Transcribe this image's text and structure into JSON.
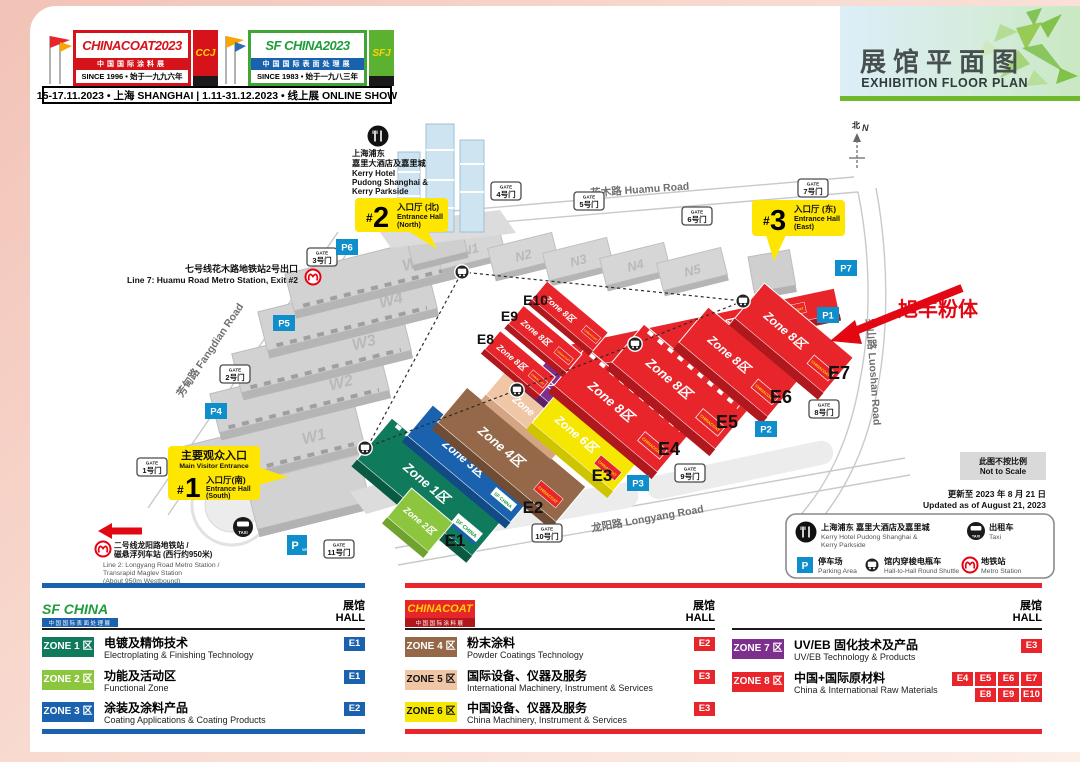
{
  "header": {
    "chinacoat": {
      "name": "CHINACOAT",
      "year": "2023",
      "tagline": "中国国际涂料展",
      "since": "SINCE 1996 • 始于一九九六年",
      "badge": "CCJ"
    },
    "sfchina": {
      "name": "SF CHINA",
      "year": "2023",
      "tagline": "中国国际表面处理展",
      "since": "SINCE 1983 • 始于一九八三年",
      "badge": "SFJ"
    },
    "dates": "15-17.11.2023 • 上海 SHANGHAI | 1.11-31.12.2023 • 线上展 ONLINE SHOW",
    "title_cn": "展馆平面图",
    "title_en": "EXHIBITION FLOOR PLAN"
  },
  "map": {
    "compass": {
      "cn": "北",
      "en": "N"
    },
    "roads": {
      "huamu": "花木路  Huamu Road",
      "fangdian": "芳甸路  Fangdian Road",
      "longyang": "龙阳路  Longyang Road",
      "luoshan": "罗山路  Luoshan Road"
    },
    "kerry": {
      "cn1": "上海浦东",
      "cn2": "嘉里大酒店及嘉里城",
      "en1": "Kerry Hotel",
      "en2": "Pudong Shanghai &",
      "en3": "Kerry Parkside"
    },
    "metro_line7": {
      "cn": "七号线花木路地铁站2号出口",
      "en": "Line 7: Huamu Road Metro Station, Exit #2"
    },
    "metro_line2": {
      "cn1": "二号线龙阳路地铁站 /",
      "cn2": "磁悬浮列车站 (西行约950米)",
      "en1": "Line 2: Longyang Road Metro Station /",
      "en2": "Transrapid Maglev Station",
      "en3": "(About 950m Westbound)"
    },
    "entrance1": {
      "main_cn": "主要观众入口",
      "main_en": "Main Visitor Entrance",
      "hash": "#",
      "num": "1",
      "cn": "入口厅(南)",
      "en1": "Entrance Hall",
      "en2": "(South)"
    },
    "entrance2": {
      "hash": "#",
      "num": "2",
      "cn": "入口厅 (北)",
      "en1": "Entrance Hall",
      "en2": "(North)"
    },
    "entrance3": {
      "hash": "#",
      "num": "3",
      "cn": "入口厅 (东)",
      "en1": "Entrance Hall",
      "en2": "(East)"
    },
    "gate_word": "GATE",
    "gates": [
      "1号门",
      "2号门",
      "3号门",
      "4号门",
      "5号门",
      "6号门",
      "7号门",
      "8号门",
      "9号门",
      "10号门",
      "11号门"
    ],
    "parkings": [
      "P1",
      "P2",
      "P3",
      "P4",
      "P5",
      "P6",
      "P7"
    ],
    "parking_vip": {
      "p": "P",
      "sub": "VIP"
    },
    "west_halls": [
      "W1",
      "W2",
      "W3",
      "W4",
      "W5"
    ],
    "north_halls": [
      "N1",
      "N2",
      "N3",
      "N4",
      "N5"
    ],
    "hall_labels": [
      "E1",
      "E2",
      "E3",
      "E4",
      "E5",
      "E6",
      "E7",
      "E8",
      "E9",
      "E10"
    ],
    "zones": {
      "z1": "Zone 1区",
      "z2": "Zone 2区",
      "z3": "Zone 3区",
      "z4": "Zone 4区",
      "z5": "Zone 5区",
      "z6": "Zone 6区",
      "z7": "Zone 7区",
      "z8": "Zone 8区"
    },
    "badge_sfchina": "SF CHINA",
    "badge_chinacoat": "CHINACOAT",
    "taxi_label": "TAXI",
    "annotation": "旭丰粉体",
    "not_to_scale_cn": "此图不按比例",
    "not_to_scale_en": "Not to Scale",
    "updated_cn": "更新至 2023 年 8 月 21 日",
    "updated_en": "Updated as of August 21, 2023",
    "legend": {
      "kerry_cn": "上海浦东 嘉里大酒店及嘉里城",
      "kerry_en1": "Kerry Hotel Pudong Shanghai &",
      "kerry_en2": "Kerry Parkside",
      "taxi_cn": "出租车",
      "taxi_en": "Taxi",
      "parking_cn": "停车场",
      "parking_en": "Parking Area",
      "shuttle_cn": "馆内穿梭电瓶车",
      "shuttle_en": "Hall-to-Hall Round Shuttle",
      "metro_cn": "地铁站",
      "metro_en": "Metro Station"
    }
  },
  "tables": {
    "hall_cn": "展馆",
    "hall_en": "HALL",
    "sf": [
      {
        "zone": "ZONE 1 区",
        "cn": "电镀及精饰技术",
        "en": "Electroplating & Finishing Technology",
        "halls": [
          "E1"
        ]
      },
      {
        "zone": "ZONE 2 区",
        "cn": "功能及活动区",
        "en": "Functional Zone",
        "halls": [
          "E1"
        ]
      },
      {
        "zone": "ZONE 3 区",
        "cn": "涂装及涂料产品",
        "en": "Coating Applications & Coating Products",
        "halls": [
          "E2"
        ]
      }
    ],
    "cc": [
      {
        "zone": "ZONE 4 区",
        "cn": "粉末涂料",
        "en": "Powder Coatings Technology",
        "halls": [
          "E2"
        ]
      },
      {
        "zone": "ZONE 5 区",
        "cn": "国际设备、仪器及服务",
        "en": "International Machinery, Instrument & Services",
        "halls": [
          "E3"
        ]
      },
      {
        "zone": "ZONE 6 区",
        "cn": "中国设备、仪器及服务",
        "en": "China Machinery, Instrument & Services",
        "halls": [
          "E3"
        ]
      }
    ],
    "uv": [
      {
        "zone": "ZONE 7 区",
        "cn": "UV/EB 固化技术及产品",
        "en": "UV/EB Technology & Products",
        "halls": [
          "E3"
        ]
      },
      {
        "zone": "ZONE 8 区",
        "cn": "中国+国际原材料",
        "en": "China & International Raw Materials",
        "halls": [
          "E4",
          "E5",
          "E6",
          "E7",
          "E8",
          "E9",
          "E10"
        ]
      }
    ]
  },
  "colors": {
    "zone1": "#107a5c",
    "zone2": "#8cc63e",
    "zone3": "#1a62ae",
    "zone4": "#946849",
    "zone5": "#efc6a6",
    "zone6": "#f6e700",
    "zone7": "#7d2f8d",
    "zone8": "#e8252b",
    "hall_badge_blue": "#1a62ae",
    "hall_badge_red": "#e8252b",
    "parking_blue": "#0e8ecb",
    "entrance_yellow": "#ffe600",
    "metro_red": "#e60012",
    "banner_green": "#6eb92b",
    "frame_pink": "#f2c3b7"
  }
}
